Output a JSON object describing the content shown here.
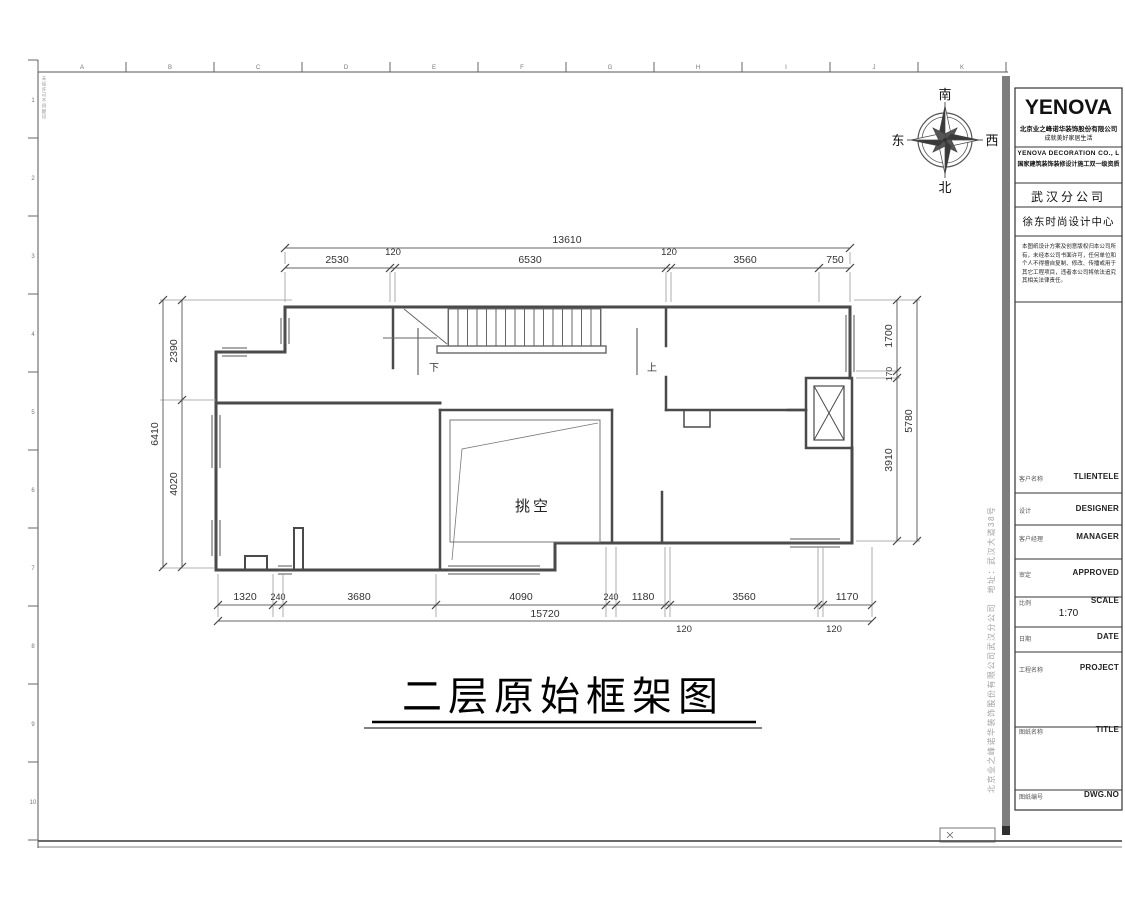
{
  "sheet": {
    "grid_letters": [
      "A",
      "B",
      "C",
      "D",
      "E",
      "F",
      "G",
      "H",
      "I",
      "J",
      "K"
    ],
    "grid_numbers": [
      "1",
      "2",
      "3",
      "4",
      "5",
      "6",
      "7",
      "8",
      "9",
      "10"
    ],
    "frame_note": "未经许可不得翻印"
  },
  "compass": {
    "north": "北",
    "south": "南",
    "east": "东",
    "west": "西"
  },
  "plan": {
    "void_label": "挑空",
    "stair_down": "下",
    "stair_up": "上",
    "title": "二层原始框架图",
    "dims": {
      "top_total": "13610",
      "top": [
        "2530",
        "120",
        "6530",
        "120",
        "3560",
        "750"
      ],
      "bottom": [
        "1320",
        "240",
        "3680",
        "4090",
        "240",
        "1180",
        "3560",
        "1170"
      ],
      "bottom_offsets": [
        "120",
        "120"
      ],
      "bottom_total": "15720",
      "left": [
        "2390",
        "4020"
      ],
      "left_total": "6410",
      "right": [
        "1700",
        "170",
        "3910"
      ],
      "right_total": "5780"
    }
  },
  "titleblock": {
    "logo": "YENOVA",
    "company_cn_1": "北京业之峰诺华装饰股份有限公司",
    "company_cn_2": "成就美好家居生活",
    "company_en": "YENOVA  DECORATION  CO.,  L",
    "qualification": "国家建筑装饰装修设计施工双一级资质",
    "branch": "武汉分公司",
    "design_center": "徐东时尚设计中心",
    "notice": "本图纸设计方案及创意版权归本公司所有，未经本公司书面许可，任何单位和个人不得擅自复制、修改、传播或用于其它工程项目，违者本公司将依法追究其相关法律责任。",
    "scale_value": "1:70",
    "rows": [
      {
        "cn": "客户名称",
        "en": "TLIENTELE"
      },
      {
        "cn": "设计",
        "en": "DESIGNER"
      },
      {
        "cn": "客户经理",
        "en": "MANAGER"
      },
      {
        "cn": "审定",
        "en": "APPROVED"
      },
      {
        "cn": "比例",
        "en": "SCALE"
      },
      {
        "cn": "日期",
        "en": "DATE"
      },
      {
        "cn": "工程名称",
        "en": "PROJECT"
      },
      {
        "cn": "图纸名称",
        "en": "TITLE"
      },
      {
        "cn": "图纸编号",
        "en": "DWG.NO"
      }
    ],
    "side_note": "北京业之峰诺华装饰股份有限公司武汉分公司　地址：武汉大道38号"
  }
}
